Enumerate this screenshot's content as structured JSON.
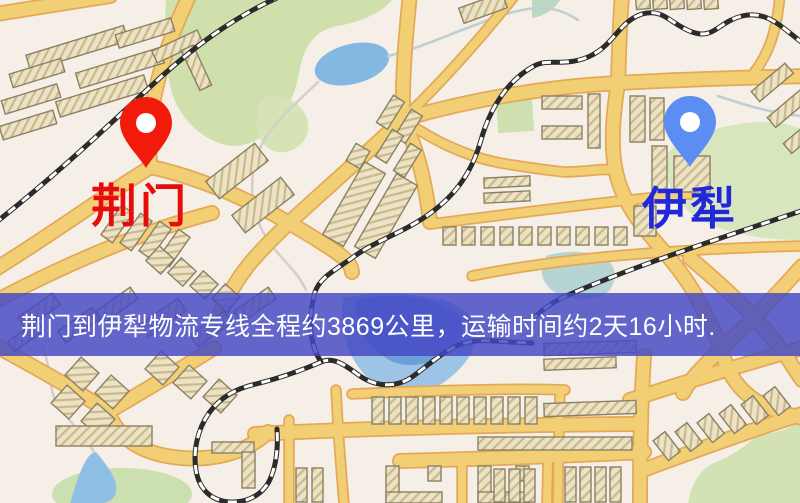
{
  "map": {
    "kind": "logistics-route-street-map",
    "markers": [
      {
        "id": "origin",
        "label": "荆门",
        "pin_color": "#f21a0b",
        "pin_hole_color": "#ffffff",
        "label_color": "#e60d0d"
      },
      {
        "id": "destination",
        "label": "伊犁",
        "pin_color": "#5c8df2",
        "pin_hole_color": "#ffffff",
        "label_color": "#2227d8"
      }
    ],
    "palette": {
      "background": "#f6efe7",
      "road": "#f2cf74",
      "road_edge": "#e3a958",
      "building": "#ede3c4",
      "park": "#cfe0ad",
      "water": "#84b9e2",
      "railway": "#2b2b2b"
    }
  },
  "banner": {
    "text": "荆门到伊犁物流专线全程约3869公里，运输时间约2天16小时.",
    "background_rgba": "rgba(68,72,196,0.83)",
    "text_color": "#ffffff"
  }
}
